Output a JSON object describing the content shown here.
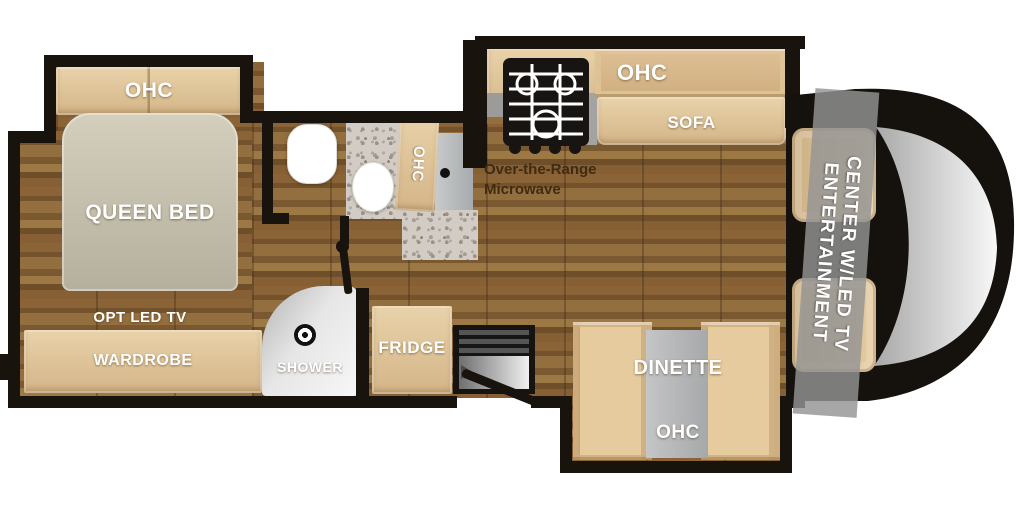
{
  "diagram": {
    "type": "rv-motorhome-floorplan",
    "labels": {
      "bedroom": {
        "ohc": "OHC",
        "queen_bed": "QUEEN BED",
        "opt_led_tv": "OPT LED TV",
        "wardrobe": "WARDROBE"
      },
      "bath": {
        "shower": "SHOWER",
        "ohc": "OHC"
      },
      "kitchen": {
        "fridge": "FRIDGE",
        "otr_line1": "Over-the-Range",
        "otr_line2": "Microwave",
        "ohc": "OHC"
      },
      "living": {
        "sofa": "SOFA",
        "dinette": "DINETTE",
        "dinette_ohc": "OHC"
      },
      "front": {
        "ent_line1": "ENTERTAINMENT",
        "ent_line2": "CENTER W/LED TV"
      }
    },
    "colors": {
      "wall": "#18130d",
      "wood_floor": "#7d5d35",
      "cabinet_tan": "#ddc094",
      "bed_gray": "#c3beac",
      "counter_granite": "#d3ccc4",
      "appliance_gray": "#b3b5b7",
      "shower_silver": "#d9d9d9",
      "label_text": "#ffffff",
      "microwave_text": "#3f2c12",
      "background": "#ffffff"
    }
  }
}
